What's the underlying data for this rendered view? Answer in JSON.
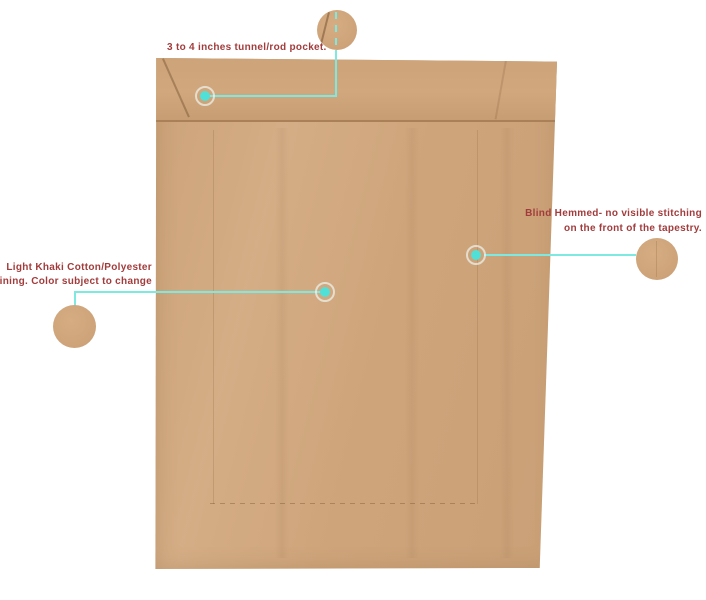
{
  "figure": {
    "type": "annotated-product-photo",
    "subject": "Back view of a light khaki tapestry lining with callout details"
  },
  "colors": {
    "background": "#ffffff",
    "fabric_khaki": "#d2a87e",
    "callout_accent_teal": "#7de9e1",
    "hotspot_dot_teal": "#50e0d7",
    "label_text_red": "#a23c3c"
  },
  "annotations": {
    "rod_pocket": {
      "label": "3 to 4 inches tunnel/rod pocket.",
      "hotspot_icon": "teal-dot",
      "detail_icon": "magnified-fabric-circle"
    },
    "blind_hem": {
      "label_line1": "Blind Hemmed- no visible stitching",
      "label_line2": "on the front of the tapestry.",
      "hotspot_icon": "teal-dot",
      "detail_icon": "magnified-fabric-circle"
    },
    "lining": {
      "label_line1": "Light Khaki Cotton/Polyester",
      "label_line2": "lining. Color subject to change",
      "hotspot_icon": "teal-dot",
      "detail_icon": "magnified-fabric-circle"
    }
  }
}
